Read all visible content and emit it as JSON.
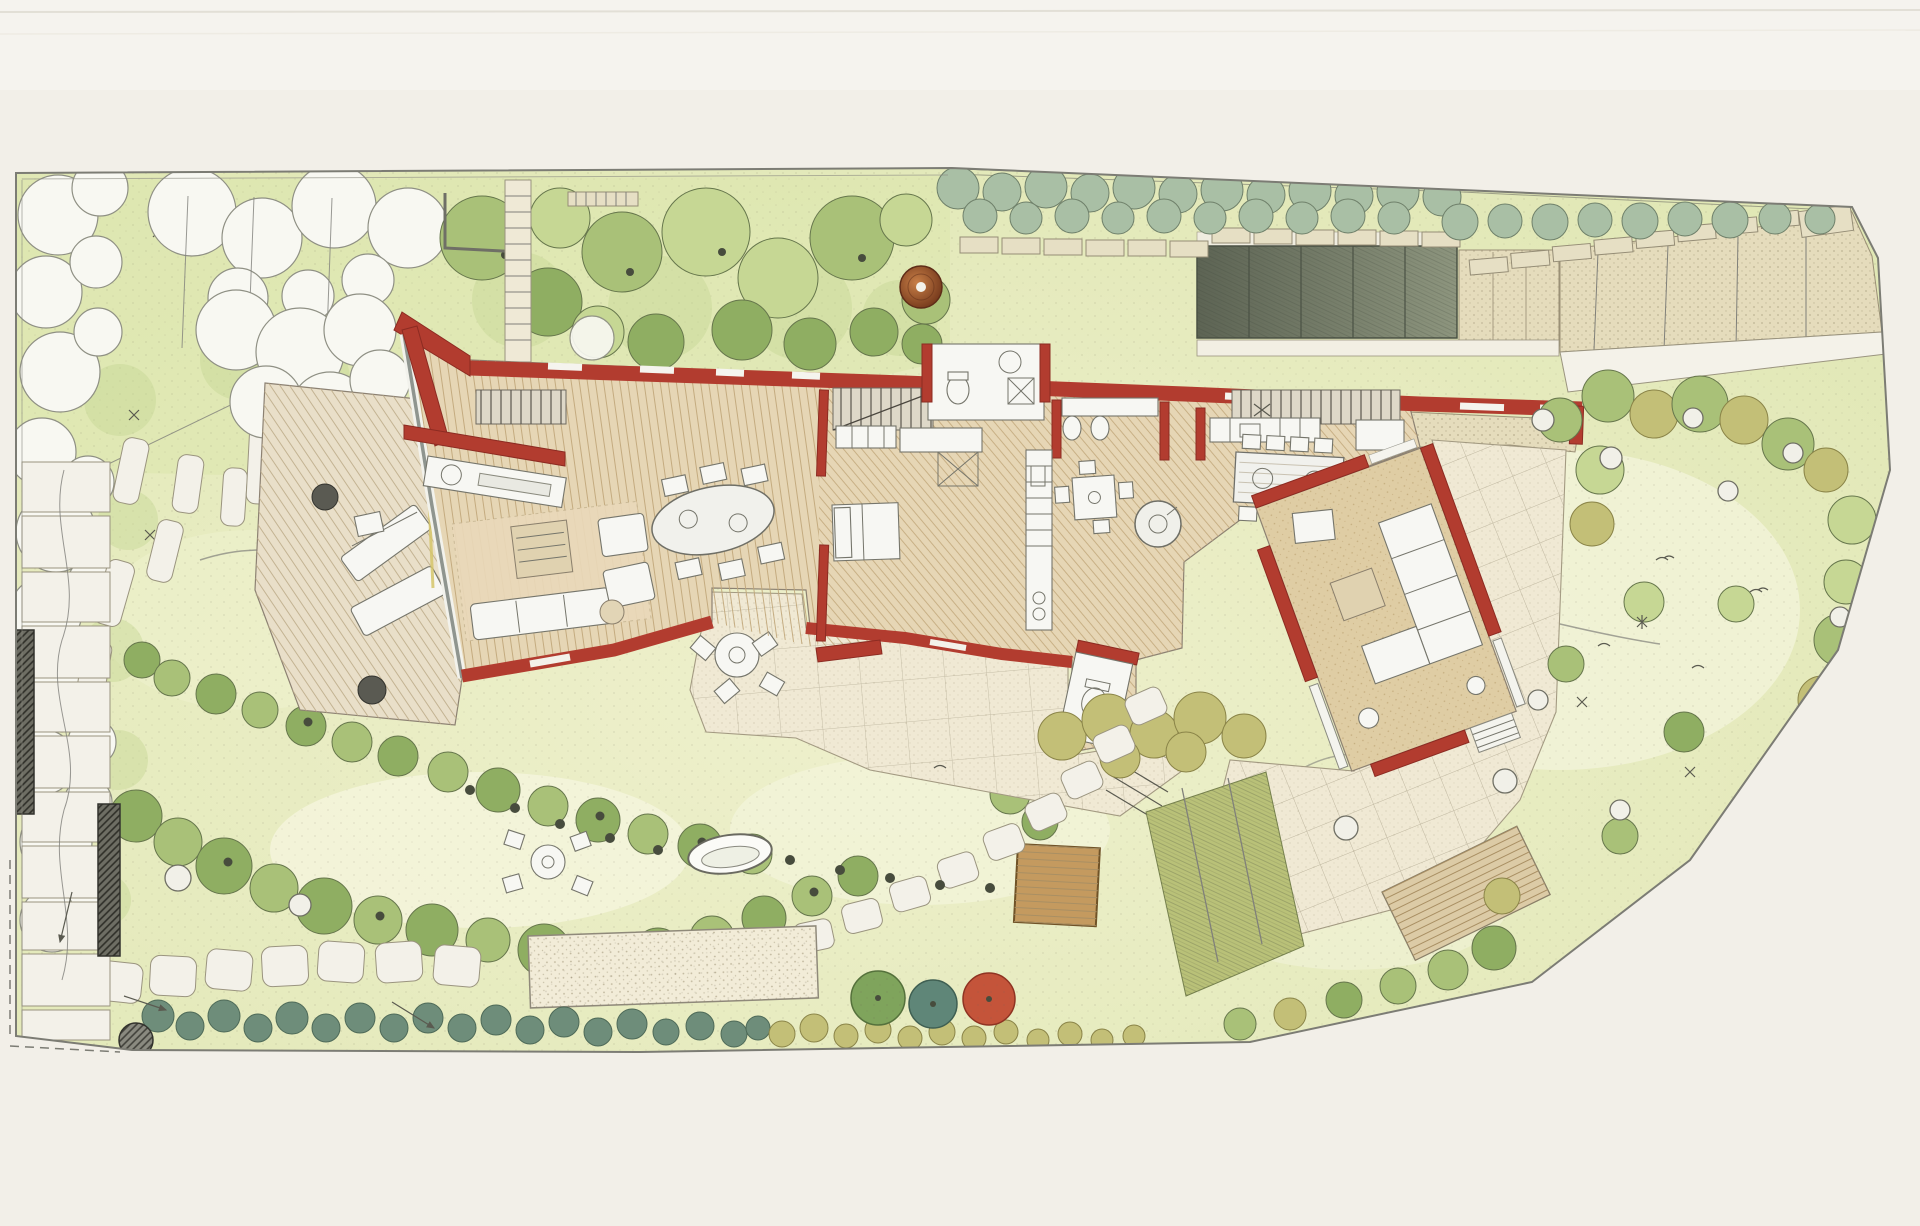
{
  "image": {
    "kind": "hand-rendered residential landscape masterplan (top-down site plan)",
    "description": "Colored-pencil and ink site plan: a long walled garden with layered shrub borders, lawns and stone paths surrounding an angled single-storey house drawn with red walls, timber floors, a west sun deck, a rotated garden-room wing on a stone terrace, a kitchen garden, sheds, stepping stones and specimen trees",
    "visible_text": []
  },
  "palette": {
    "paper": "#f2efe8",
    "paper-edge": "#e7e4db",
    "pencil": "#80807a",
    "lawn": "#e7ecc2",
    "lawn-light": "#f4f5dc",
    "lawn-dark": "#dce6ae",
    "leaf-light": "#c6d794",
    "leaf-mid": "#a9c178",
    "leaf-dark": "#8fae62",
    "leaf-stroke": "#66764c",
    "white-veg": "#f8f8f2",
    "gray-green": "#a9bfa5",
    "gray-green-stroke": "#6f806a",
    "teal": "#6e8d7a",
    "teal-dark": "#4e6a58",
    "teal-tree": "#5f8678",
    "red-tree": "#c4543a",
    "olive": "#c3bf77",
    "olive-dark": "#8a8448",
    "wall-red": "#b23c2f",
    "wall-red-dark": "#8c2b22",
    "wood": "#e6d6b5",
    "tan": "#dfcda4",
    "cream": "#f0e9d4",
    "sand": "#e5dcbc",
    "dark-court": "#77806b",
    "shed": "#c49a5f",
    "fixture": "#f7f7f3",
    "fixture-stroke": "#75756b",
    "pot": "#a05a31",
    "stone-dark": "#6b6b62"
  },
  "regions": [
    "site-boundary",
    "left-shrub-border",
    "top-shrub-border",
    "boundary-wall",
    "copper-pot-feature",
    "gravel-court",
    "entrance-court",
    "entrance-path",
    "house-north-wall",
    "living-room",
    "west-sun-deck",
    "stair",
    "bedrooms-and-bathrooms",
    "kitchen-dining",
    "garden-room-wing",
    "stone-terrace",
    "timber-deck",
    "south-paved-band",
    "round-patio-table",
    "meadow-seating",
    "water-bowl",
    "gravel-bed",
    "stepping-stones",
    "garden-shed",
    "kitchen-garden-beds",
    "specimen-trees",
    "right-meadow",
    "bottom-hedge",
    "left-stone-path",
    "retaining-walls",
    "standing-stone-slabs"
  ]
}
